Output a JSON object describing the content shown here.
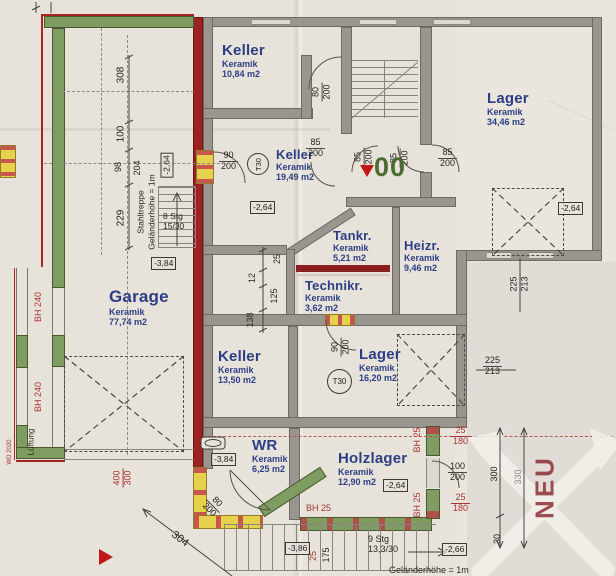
{
  "colors": {
    "paper": "#e7e3da",
    "wall_gray": "#9a968f",
    "wall_red": "#9e2121",
    "wall_green": "#7f9d62",
    "wall_yellow": "#e5d14c",
    "label_blue": "#2e3e85",
    "dim_red": "#a83434",
    "neu_red": "#8c3038",
    "level_green": "#4c6b33"
  },
  "rooms": {
    "keller_top": {
      "name": "Keller",
      "material": "Keramik",
      "area": "10,84 m2"
    },
    "lager_big": {
      "name": "Lager",
      "material": "Keramik",
      "area": "34,46 m2"
    },
    "keller_mid": {
      "name": "Keller",
      "material": "Keramik",
      "area": "19,49 m2"
    },
    "tankraum": {
      "name": "Tankr.",
      "material": "Keramik",
      "area": "5,21 m2"
    },
    "heizraum": {
      "name": "Heizr.",
      "material": "Keramik",
      "area": "9,46 m2"
    },
    "technikraum": {
      "name": "Technikr.",
      "material": "Keramik",
      "area": "3,62 m2"
    },
    "garage": {
      "name": "Garage",
      "material": "Keramik",
      "area": "77,74 m2"
    },
    "keller_low": {
      "name": "Keller",
      "material": "Keramik",
      "area": "13,50 m2"
    },
    "lager_small": {
      "name": "Lager",
      "material": "Keramik",
      "area": "16,20 m2"
    },
    "waschraum": {
      "name": "WR",
      "material": "Keramik",
      "area": "6,25 m2"
    },
    "holzlager": {
      "name": "Holzlager",
      "material": "Keramik",
      "area": "12,90 m2"
    }
  },
  "levels": {
    "keller_mid": "-2,64",
    "keller_mid_rot": "-2,64",
    "lager_big": "-2,64",
    "stahltreppe": "-3,84",
    "wr": "-3,84",
    "holzlager": "-2,64",
    "outside_sw": "-3,86",
    "stair_out": "-2,66"
  },
  "doors": {
    "keller_mid": {
      "w": "90",
      "h": "200"
    },
    "keller_top": {
      "w": "80",
      "h": "200"
    },
    "hall_a": {
      "w": "85",
      "h": "200"
    },
    "hall_b": {
      "w": "85",
      "h": "200"
    },
    "lager_big": {
      "w": "85",
      "h": "200"
    },
    "tankraum": {
      "w": "85",
      "h": "200"
    },
    "lager_small": {
      "w": "90",
      "h": "200"
    },
    "wr": {
      "w": "80",
      "h": "200"
    },
    "holzlager": {
      "w": "100",
      "h": "200"
    },
    "garage": {
      "w": "400",
      "h": "300"
    }
  },
  "windows": {
    "holz_a": {
      "w": "25",
      "h": "180"
    },
    "holz_b": {
      "w": "25",
      "h": "180"
    }
  },
  "dim_chains": {
    "left": [
      "308",
      "100",
      "98",
      "204",
      "229"
    ],
    "corridor": [
      "25",
      "12",
      "125",
      "138"
    ],
    "right": {
      "a": "300",
      "b": "30",
      "c": "330"
    },
    "lager_pair_v": {
      "a": "225",
      "b": "213"
    },
    "lager_pair_h": {
      "a": "225",
      "b": "213"
    },
    "outside": {
      "d304": "304",
      "d25": "25",
      "d175": "175"
    }
  },
  "stairs": {
    "steel": {
      "name": "Stahltreppe",
      "railing": "Geländerhöhe = 1m",
      "count": "8 Stg",
      "ratio": "15/30"
    },
    "outdoor": {
      "count": "9 Stg",
      "ratio": "13,3/30",
      "railing": "Geländerhöhe = 1m"
    }
  },
  "annotations": {
    "bh240": "BH 240",
    "bh25": "BH 25",
    "lueftung": "Lüftung",
    "wd": "WD 2020",
    "t30": "T30",
    "neu": "NEU",
    "level_zero": "00"
  }
}
